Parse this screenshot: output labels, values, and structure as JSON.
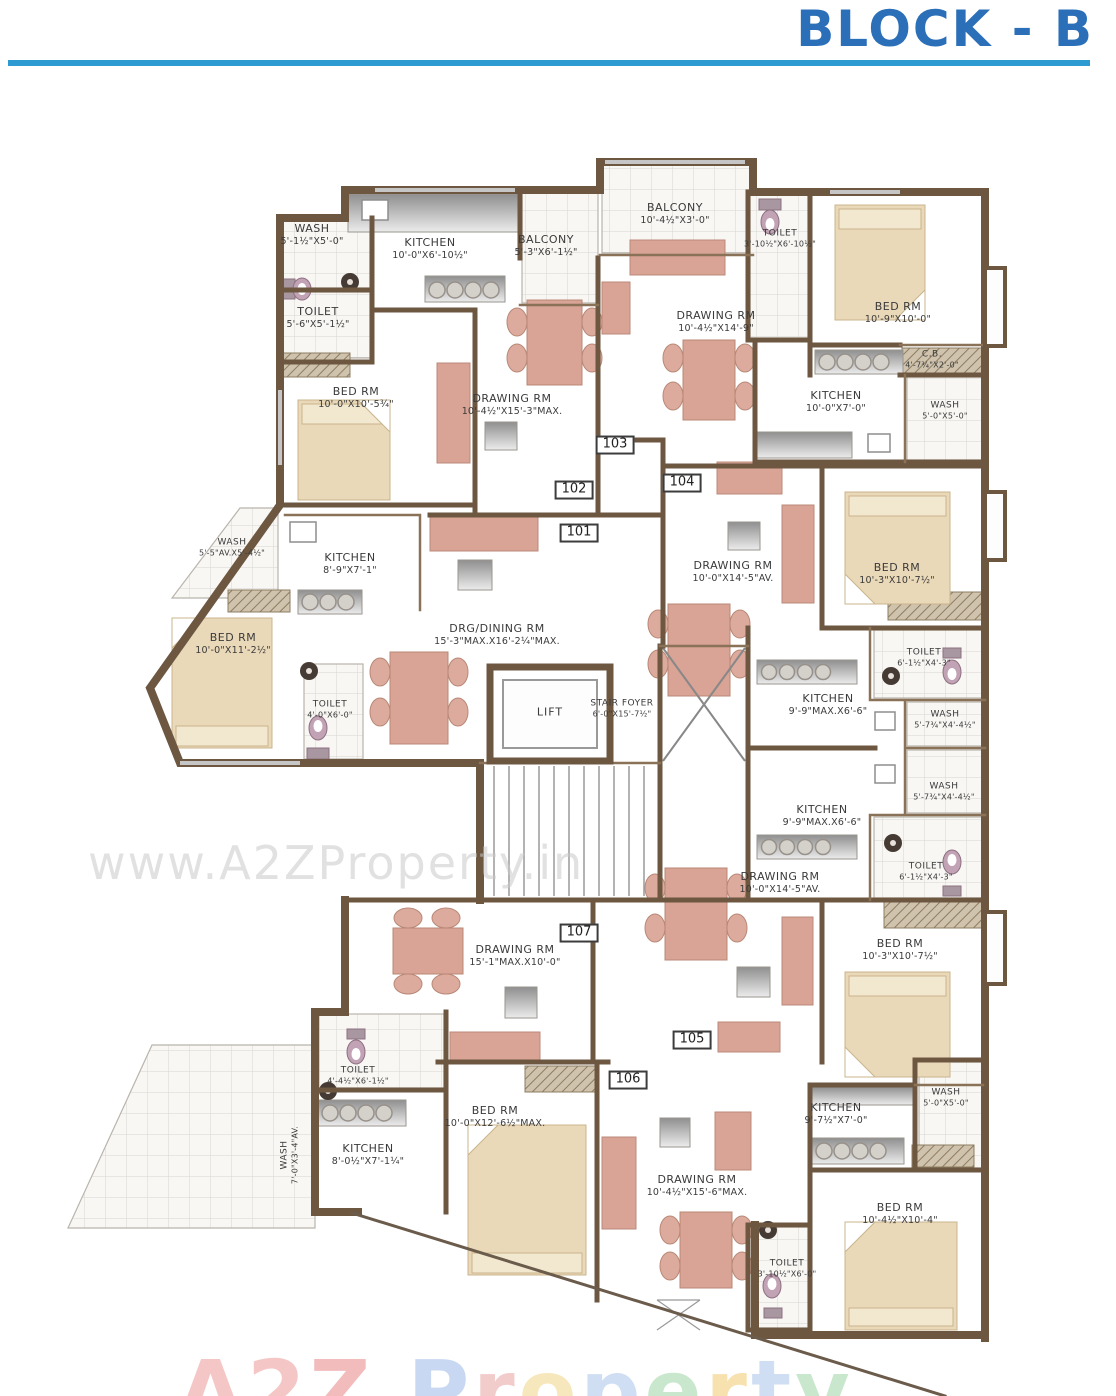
{
  "header": {
    "title": "BLOCK - B",
    "accent_color": "#2d9ad2",
    "title_color": "#2b6fb8"
  },
  "watermark": {
    "center": "www.A2ZProperty.in",
    "bottom_letters": [
      {
        "ch": "A",
        "c": "#ec9a98"
      },
      {
        "ch": "2",
        "c": "#ec9a98"
      },
      {
        "ch": "Z",
        "c": "#e88686"
      },
      {
        "ch": " ",
        "c": "#ffffff"
      },
      {
        "ch": "P",
        "c": "#9db9e8"
      },
      {
        "ch": "r",
        "c": "#e8a1a1"
      },
      {
        "ch": "o",
        "c": "#f2d488"
      },
      {
        "ch": "p",
        "c": "#a9c4ea"
      },
      {
        "ch": "e",
        "c": "#9ed4a5"
      },
      {
        "ch": "r",
        "c": "#f2c96e"
      },
      {
        "ch": "t",
        "c": "#a9c4ea"
      },
      {
        "ch": "y",
        "c": "#9ed4a5"
      }
    ]
  },
  "core": {
    "lift": "LIFT",
    "stair": {
      "name": "STAIR FOYER",
      "dims": "6'-0\"X15'-7½\""
    }
  },
  "units": [
    "101",
    "102",
    "103",
    "104",
    "105",
    "106",
    "107"
  ],
  "colors": {
    "wall": "#6d5741",
    "sofa": "#d9a395",
    "bed": "#ead9b8"
  },
  "rooms": [
    {
      "name": "WASH",
      "dims": "5'-1½\"X5'-0\""
    },
    {
      "name": "KITCHEN",
      "dims": "10'-0\"X6'-10½\""
    },
    {
      "name": "BALCONY",
      "dims": "5'-3\"X6'-1½\""
    },
    {
      "name": "TOILET",
      "dims": "5'-6\"X5'-1½\""
    },
    {
      "name": "BALCONY",
      "dims": "10'-4½\"X3'-0\""
    },
    {
      "name": "TOILET",
      "dims": "3'-10½\"X6'-10½\""
    },
    {
      "name": "BED RM",
      "dims": "10'-9\"X10'-0\""
    },
    {
      "name": "DRAWING RM",
      "dims": "10'-4½\"X14'-9\""
    },
    {
      "name": "BED RM",
      "dims": "10'-0\"X10'-5¾\""
    },
    {
      "name": "DRAWING RM",
      "dims": "10'-4½\"X15'-3\"MAX."
    },
    {
      "name": "C.B.",
      "dims": "4'-7¾\"X2'-0\""
    },
    {
      "name": "KITCHEN",
      "dims": "10'-0\"X7'-0\""
    },
    {
      "name": "WASH",
      "dims": "5'-0\"X5'-0\""
    },
    {
      "name": "WASH",
      "dims": "5'-5\"AV.X5'-4½\""
    },
    {
      "name": "KITCHEN",
      "dims": "8'-9\"X7'-1\""
    },
    {
      "name": "BED RM",
      "dims": "10'-0\"X11'-2½\""
    },
    {
      "name": "DRG/DINING RM",
      "dims": "15'-3\"MAX.X16'-2¼\"MAX."
    },
    {
      "name": "TOILET",
      "dims": "4'-0\"X6'-0\""
    },
    {
      "name": "DRAWING RM",
      "dims": "10'-0\"X14'-5\"AV."
    },
    {
      "name": "BED RM",
      "dims": "10'-3\"X10'-7½\""
    },
    {
      "name": "TOILET",
      "dims": "6'-1½\"X4'-3\""
    },
    {
      "name": "KITCHEN",
      "dims": "9'-9\"MAX.X6'-6\""
    },
    {
      "name": "WASH",
      "dims": "5'-7¾\"X4'-4½\""
    },
    {
      "name": "WASH",
      "dims": "5'-7¾\"X4'-4½\""
    },
    {
      "name": "KITCHEN",
      "dims": "9'-9\"MAX.X6'-6\""
    },
    {
      "name": "TOILET",
      "dims": "6'-1½\"X4'-3\""
    },
    {
      "name": "DRAWING RM",
      "dims": "10'-0\"X14'-5\"AV."
    },
    {
      "name": "BED RM",
      "dims": "10'-3\"X10'-7½\""
    },
    {
      "name": "DRAWING RM",
      "dims": "15'-1\"MAX.X10'-0\""
    },
    {
      "name": "TOILET",
      "dims": "4'-4½\"X6'-1½\""
    },
    {
      "name": "BED RM",
      "dims": "10'-0\"X12'-6½\"MAX."
    },
    {
      "name": "KITCHEN",
      "dims": "8'-0½\"X7'-1¼\""
    },
    {
      "name": "WASH",
      "dims": "7'-0\"X3'-4\"AV."
    },
    {
      "name": "DRAWING RM",
      "dims": "10'-4½\"X15'-6\"MAX."
    },
    {
      "name": "KITCHEN",
      "dims": "9'-7½\"X7'-0\""
    },
    {
      "name": "WASH",
      "dims": "5'-0\"X5'-0\""
    },
    {
      "name": "BED RM",
      "dims": "10'-4½\"X10'-4\""
    },
    {
      "name": "TOILET",
      "dims": "3'-10½\"X6'-0\""
    }
  ]
}
